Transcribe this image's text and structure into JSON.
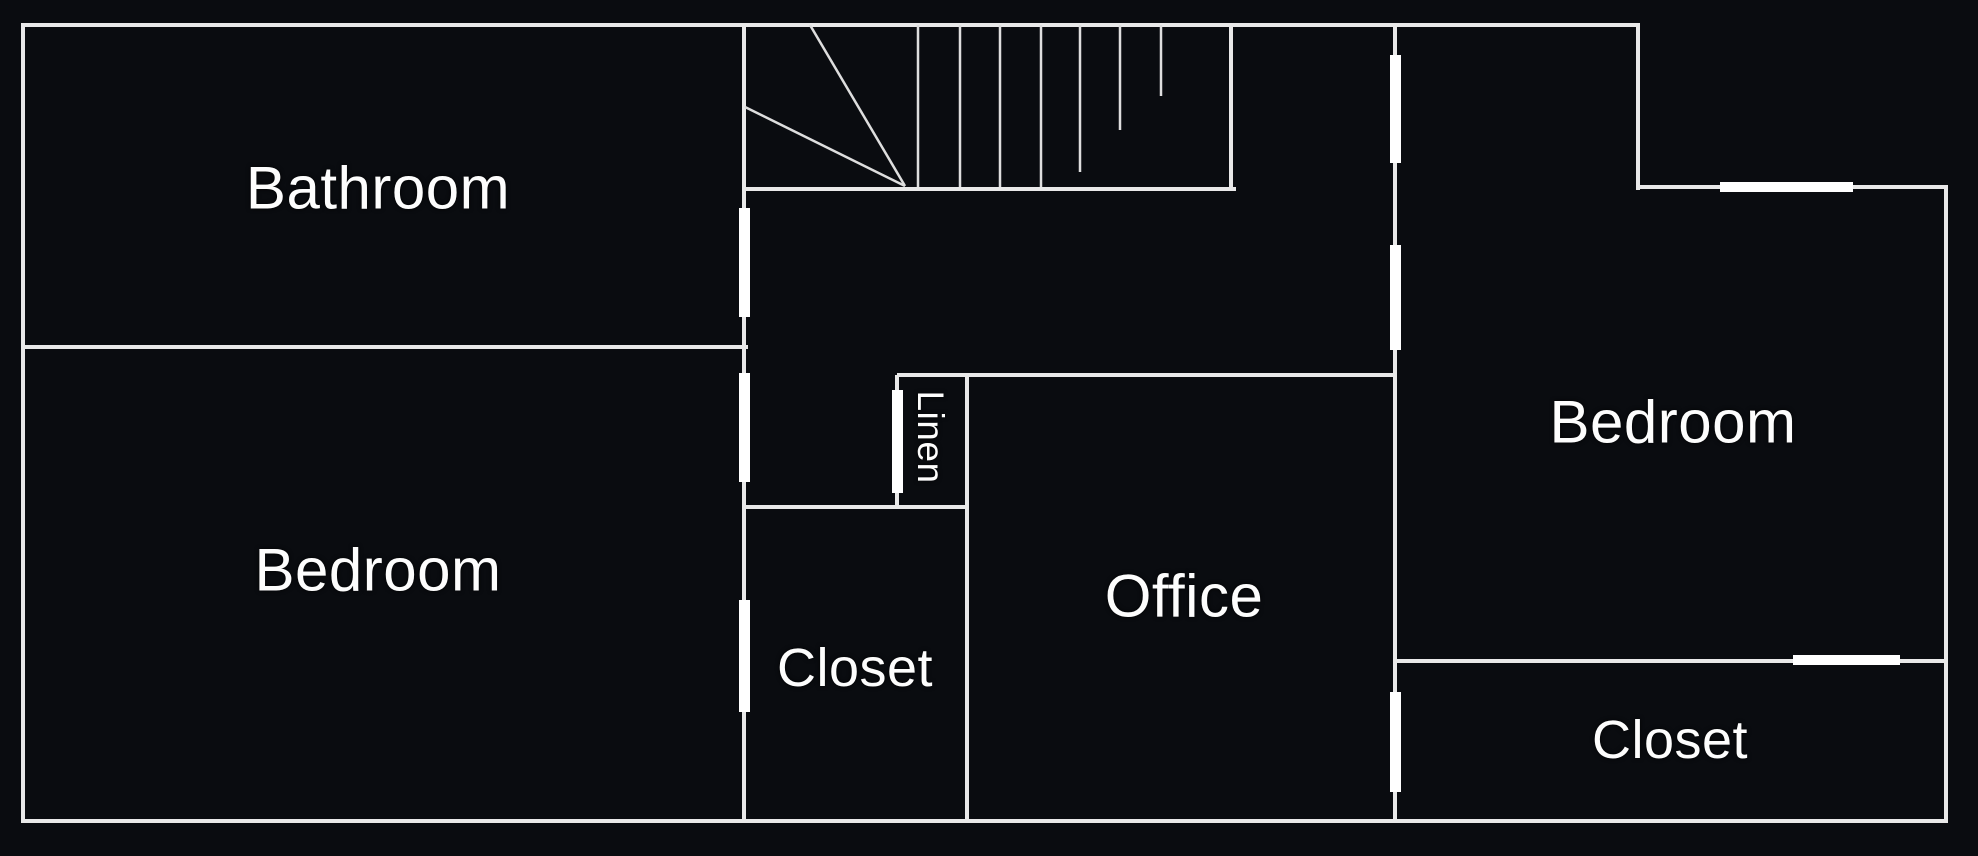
{
  "canvas": {
    "width": 1978,
    "height": 856,
    "background_color": "#0a0c10",
    "wall_color": "#e9e9e9",
    "stair_line_color": "#dedede",
    "opening_color": "#ffffff",
    "label_color": "#fdfdfd"
  },
  "rooms": {
    "bathroom": {
      "name": "Bathroom"
    },
    "bedroom_left": {
      "name": "Bedroom"
    },
    "closet_left": {
      "name": "Closet"
    },
    "linen": {
      "name": "Linen"
    },
    "office": {
      "name": "Office"
    },
    "bedroom_right": {
      "name": "Bedroom"
    },
    "closet_right": {
      "name": "Closet"
    }
  },
  "geometry": {
    "wall_thickness": 4,
    "walls": [
      {
        "name": "outer-top-wall",
        "dir": "h",
        "x": 21,
        "y": 23,
        "len": 1619
      },
      {
        "name": "outer-left-wall",
        "dir": "v",
        "x": 21,
        "y": 23,
        "len": 800
      },
      {
        "name": "outer-bottom-wall",
        "dir": "h",
        "x": 21,
        "y": 819,
        "len": 1927
      },
      {
        "name": "outer-right-wall",
        "dir": "v",
        "x": 1944,
        "y": 187,
        "len": 636
      },
      {
        "name": "upper-right-step-wall",
        "dir": "v",
        "x": 1636,
        "y": 23,
        "len": 167
      },
      {
        "name": "bedroom-right-top-wall",
        "dir": "h",
        "x": 1636,
        "y": 185,
        "len": 312
      },
      {
        "name": "bathroom-bedroom-divider",
        "dir": "h",
        "x": 21,
        "y": 345,
        "len": 727
      },
      {
        "name": "central-vertical-wall",
        "dir": "v",
        "x": 742,
        "y": 23,
        "len": 800
      },
      {
        "name": "stairwell-bottom-wall",
        "dir": "h",
        "x": 745,
        "y": 187,
        "len": 491
      },
      {
        "name": "stairwell-right-wall",
        "dir": "v",
        "x": 1229,
        "y": 23,
        "len": 168
      },
      {
        "name": "office-top-wall",
        "dir": "h",
        "x": 897,
        "y": 373,
        "len": 500
      },
      {
        "name": "linen-left-wall",
        "dir": "v",
        "x": 895,
        "y": 375,
        "len": 132
      },
      {
        "name": "closet-office-divider",
        "dir": "v",
        "x": 965,
        "y": 373,
        "len": 446
      },
      {
        "name": "closet-left-top-wall",
        "dir": "h",
        "x": 745,
        "y": 505,
        "len": 224
      },
      {
        "name": "hall-bedroom-right-wall",
        "dir": "v",
        "x": 1393,
        "y": 23,
        "len": 796
      },
      {
        "name": "bedroom-closet-right-divider",
        "dir": "h",
        "x": 1395,
        "y": 659,
        "len": 553
      }
    ],
    "openings": [
      {
        "name": "bathroom-door-opening",
        "x": 739,
        "y": 208,
        "w": 11,
        "h": 109
      },
      {
        "name": "bedroom-left-door-opening",
        "x": 739,
        "y": 373,
        "w": 11,
        "h": 109
      },
      {
        "name": "closet-left-door-opening",
        "x": 739,
        "y": 600,
        "w": 11,
        "h": 112
      },
      {
        "name": "linen-door-opening",
        "x": 892,
        "y": 390,
        "w": 11,
        "h": 103
      },
      {
        "name": "hall-top-door-opening",
        "x": 1390,
        "y": 55,
        "w": 11,
        "h": 108
      },
      {
        "name": "bedroom-right-door-opening",
        "x": 1390,
        "y": 245,
        "w": 11,
        "h": 105
      },
      {
        "name": "closet-right-door-opening",
        "x": 1390,
        "y": 692,
        "w": 11,
        "h": 100
      },
      {
        "name": "bedroom-right-window",
        "x": 1720,
        "y": 182,
        "w": 133,
        "h": 10
      },
      {
        "name": "closet-right-opening",
        "x": 1793,
        "y": 655,
        "w": 107,
        "h": 10
      }
    ],
    "stairs": {
      "line_width": 2.5,
      "treads": [
        {
          "name": "stair-tread",
          "x": 918,
          "y1": 25,
          "y2": 187
        },
        {
          "name": "stair-tread",
          "x": 960,
          "y1": 25,
          "y2": 187
        },
        {
          "name": "stair-tread",
          "x": 1000,
          "y1": 25,
          "y2": 187
        },
        {
          "name": "stair-tread",
          "x": 1041,
          "y1": 25,
          "y2": 187
        },
        {
          "name": "stair-tread-partial",
          "x": 1080,
          "y1": 25,
          "y2": 172
        },
        {
          "name": "stair-tread-partial",
          "x": 1120,
          "y1": 25,
          "y2": 130
        },
        {
          "name": "stair-tread-partial",
          "x": 1161,
          "y1": 25,
          "y2": 96
        }
      ],
      "winders": [
        {
          "name": "stair-winder",
          "x1": 810,
          "y1": 25,
          "x2": 905,
          "y2": 186
        },
        {
          "name": "stair-winder",
          "x1": 745,
          "y1": 107,
          "x2": 905,
          "y2": 186
        }
      ]
    }
  }
}
